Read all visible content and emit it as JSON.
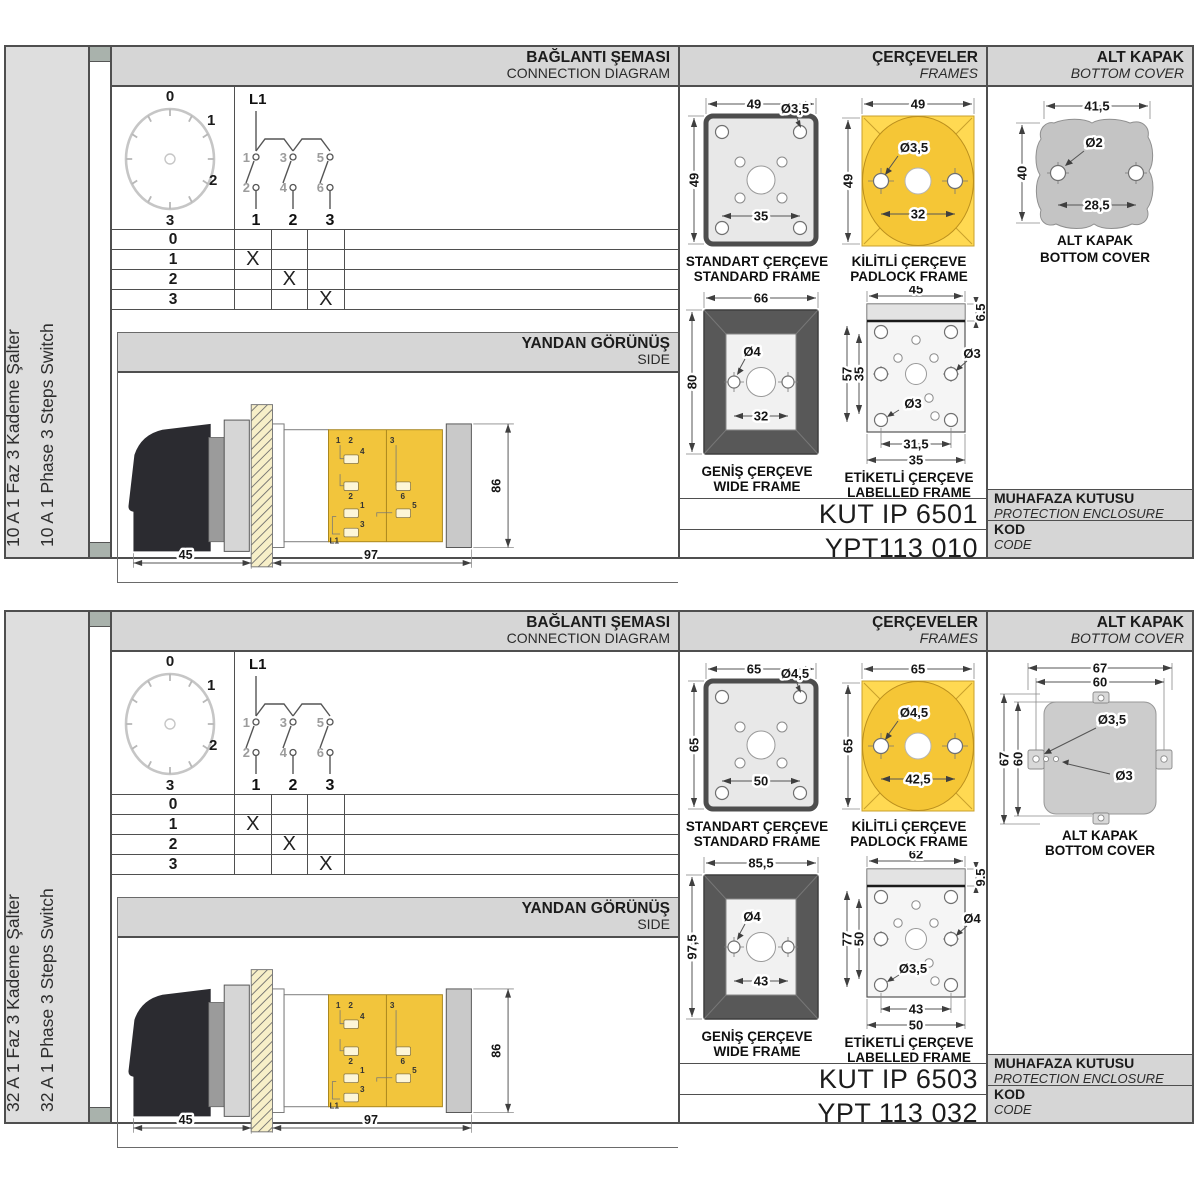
{
  "common": {
    "connection_header": {
      "tr": "BAĞLANTI ŞEMASI",
      "en": "CONNECTION DIAGRAM"
    },
    "frames_header": {
      "tr": "ÇERÇEVELER",
      "en": "FRAMES"
    },
    "cover_header": {
      "tr": "ALT KAPAK",
      "en": "BOTTOM COVER"
    },
    "side_header": {
      "tr": "YANDAN GÖRÜNÜŞ",
      "en": "SIDE"
    },
    "enclosure_label": {
      "tr": "MUHAFAZA KUTUSU",
      "en": "PROTECTION ENCLOSURE"
    },
    "code_label": {
      "tr": "KOD",
      "en": "CODE"
    },
    "dial": {
      "positions": [
        "0",
        "1",
        "2",
        "3"
      ]
    },
    "schematic": {
      "source": "L1",
      "upper_contacts": [
        "1",
        "3",
        "5"
      ],
      "lower_contacts": [
        "2",
        "4",
        "6"
      ],
      "poles": [
        "1",
        "2",
        "3"
      ]
    },
    "switch_table": {
      "rows": [
        {
          "pos": "0",
          "marks": [
            "",
            "",
            ""
          ]
        },
        {
          "pos": "1",
          "marks": [
            "X",
            "",
            ""
          ]
        },
        {
          "pos": "2",
          "marks": [
            "",
            "X",
            ""
          ]
        },
        {
          "pos": "3",
          "marks": [
            "",
            "",
            "X"
          ]
        }
      ]
    },
    "side_view": {
      "dim_front": "45",
      "dim_body": "97",
      "dim_height": "86",
      "terminal_labels": [
        "1",
        "2",
        "4",
        "2",
        "3",
        "6",
        "1",
        "5",
        "3",
        "L1"
      ]
    },
    "frame_captions": {
      "standard": {
        "tr": "STANDART ÇERÇEVE",
        "en": "STANDARD FRAME"
      },
      "padlock": {
        "tr": "KİLİTLİ ÇERÇEVE",
        "en": "PADLOCK FRAME"
      },
      "wide": {
        "tr": "GENİŞ ÇERÇEVE",
        "en": "WIDE FRAME"
      },
      "labelled": {
        "tr": "ETİKETLİ ÇERÇEVE",
        "en": "LABELLED FRAME"
      }
    },
    "cover_caption": {
      "tr": "ALT KAPAK",
      "en": "BOTTOM COVER"
    }
  },
  "sections": [
    {
      "rating_tr": "10 A 1 Faz 3 Kademe Şalter",
      "rating_en": "10 A 1 Phase 3 Steps Switch",
      "frames": {
        "standard": {
          "width": "49",
          "height": "49",
          "hole": "Ø3,5",
          "pitch": "35"
        },
        "padlock": {
          "width": "49",
          "height": "49",
          "hole": "Ø3,5",
          "pitch": "32"
        },
        "wide": {
          "width": "66",
          "height": "80",
          "hole": "Ø4",
          "pitch": "32"
        },
        "labelled": {
          "width": "45",
          "band": "6,5",
          "height": "57",
          "inner_height": "35",
          "hole_right": "Ø3",
          "hole_left": "Ø3",
          "pitch_inner": "31,5",
          "pitch_outer": "35"
        }
      },
      "bottom_cover": {
        "width": "41,5",
        "hole": "Ø2",
        "height": "40",
        "pitch": "28,5"
      },
      "enclosure_code": "KUT IP 6501",
      "product_code": "YPT113 010"
    },
    {
      "rating_tr": "32 A 1 Faz 3 Kademe Şalter",
      "rating_en": "32 A 1 Phase 3 Steps Switch",
      "frames": {
        "standard": {
          "width": "65",
          "height": "65",
          "hole": "Ø4,5",
          "pitch": "50"
        },
        "padlock": {
          "width": "65",
          "height": "65",
          "hole": "Ø4,5",
          "pitch": "42,5"
        },
        "wide": {
          "width": "85,5",
          "height": "97,5",
          "hole": "Ø4",
          "pitch": "43"
        },
        "labelled": {
          "width": "62",
          "band": "9,5",
          "height": "77",
          "inner_height": "50",
          "hole_right": "Ø4",
          "hole_left": "Ø3,5",
          "pitch_inner": "43",
          "pitch_outer": "50"
        }
      },
      "bottom_cover": {
        "width_outer": "67",
        "width_inner": "60",
        "height_outer": "67",
        "height_inner": "60",
        "hole_tab": "Ø3,5",
        "hole_body": "Ø3"
      },
      "enclosure_code": "KUT IP 6503",
      "product_code": "YPT 113 032"
    }
  ],
  "colors": {
    "body_yellow": "#f2c53c",
    "padlock_yellow": "#ffd952",
    "padlock_circle": "#f5c636",
    "frame_dark": "#585858",
    "band_gray": "#d6d6d6",
    "cover_gray": "#c4c4c4"
  }
}
